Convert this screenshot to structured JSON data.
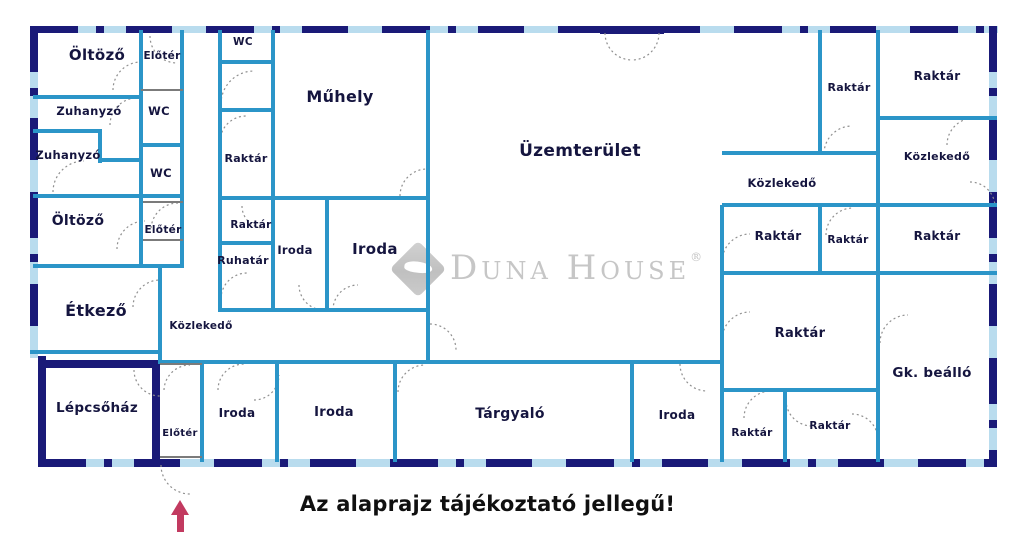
{
  "caption": "Az alaprajz tájékoztató jellegű!",
  "watermark": {
    "name": "Duna House",
    "mark": "®"
  },
  "icons": {
    "entrance_arrow": "up-arrow",
    "doors": "quarter-circle-door-swing"
  },
  "colors": {
    "outer_wall": "#1a1a78",
    "window": "#b9dcee",
    "inner_wall": "#2b95c8",
    "label_text": "#15153f",
    "caption_text": "#101010",
    "arrow": "#c23a60",
    "watermark_gray": "#c6c6c6",
    "door_arc": "#8f8f8f"
  },
  "rooms": [
    {
      "id": "oltozo-1",
      "label": "Öltöző"
    },
    {
      "id": "eloter-1",
      "label": "Előtér"
    },
    {
      "id": "zuhanyzo-1",
      "label": "Zuhanyzó"
    },
    {
      "id": "wc-1",
      "label": "WC"
    },
    {
      "id": "zuhanyzo-2",
      "label": "Zuhanyzó"
    },
    {
      "id": "wc-2",
      "label": "WC"
    },
    {
      "id": "oltozo-2",
      "label": "Öltöző"
    },
    {
      "id": "eloter-2",
      "label": "Előtér"
    },
    {
      "id": "etkezo",
      "label": "Étkező"
    },
    {
      "id": "wc-3",
      "label": "WC"
    },
    {
      "id": "raktar-c1",
      "label": "Raktár"
    },
    {
      "id": "raktar-c2",
      "label": "Raktár"
    },
    {
      "id": "ruhatar",
      "label": "Ruhatár"
    },
    {
      "id": "muhely",
      "label": "Műhely"
    },
    {
      "id": "iroda-m1",
      "label": "Iroda"
    },
    {
      "id": "iroda-m2",
      "label": "Iroda"
    },
    {
      "id": "uzemterulet",
      "label": "Üzemterület"
    },
    {
      "id": "kozlekedo-1",
      "label": "Közlekedő"
    },
    {
      "id": "raktar-t1",
      "label": "Raktár"
    },
    {
      "id": "raktar-t2",
      "label": "Raktár"
    },
    {
      "id": "kozlekedo-2",
      "label": "Közlekedő"
    },
    {
      "id": "kozlekedo-3",
      "label": "Közlekedő"
    },
    {
      "id": "raktar-m1",
      "label": "Raktár"
    },
    {
      "id": "raktar-m2",
      "label": "Raktár"
    },
    {
      "id": "raktar-m3",
      "label": "Raktár"
    },
    {
      "id": "raktar-big",
      "label": "Raktár"
    },
    {
      "id": "gk-beallo",
      "label": "Gk. beálló"
    },
    {
      "id": "lepcsohaz",
      "label": "Lépcsőház"
    },
    {
      "id": "eloter-3",
      "label": "Előtér"
    },
    {
      "id": "iroda-b1",
      "label": "Iroda"
    },
    {
      "id": "iroda-b2",
      "label": "Iroda"
    },
    {
      "id": "targyalo",
      "label": "Tárgyaló"
    },
    {
      "id": "iroda-b3",
      "label": "Iroda"
    },
    {
      "id": "raktar-b1",
      "label": "Raktár"
    },
    {
      "id": "raktar-b2",
      "label": "Raktár"
    }
  ]
}
